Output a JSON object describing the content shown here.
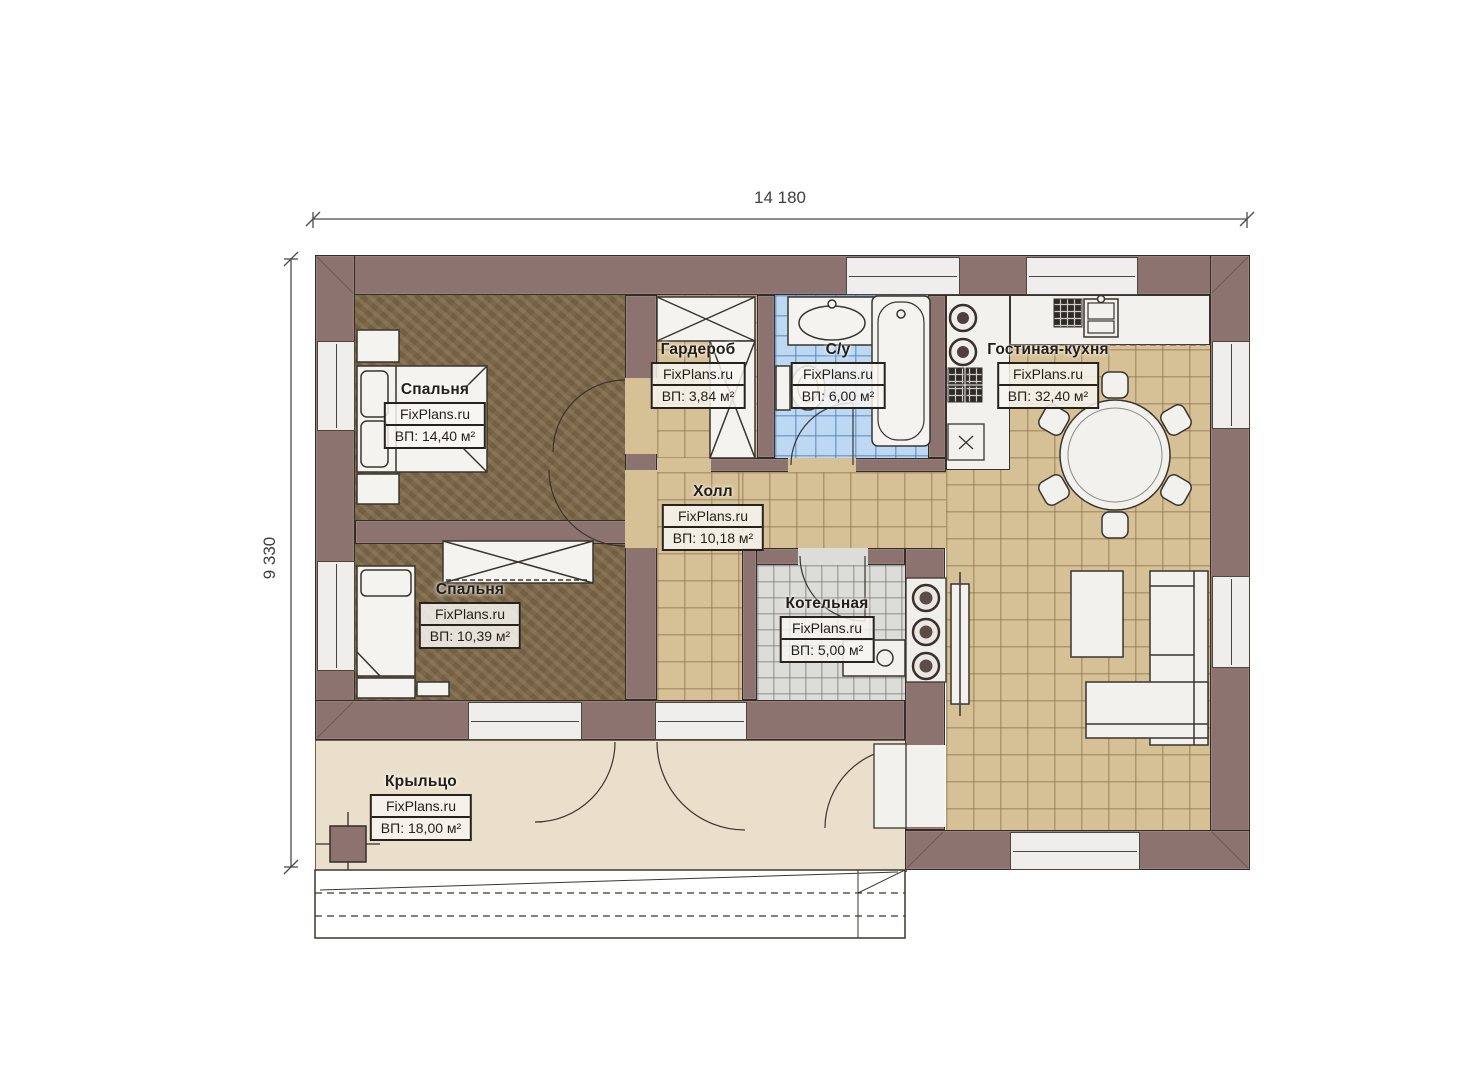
{
  "dimensions": {
    "width_label": "14 180",
    "height_label": "9 330"
  },
  "rooms": [
    {
      "id": "bedroom-1",
      "name": "Спальня",
      "brand": "FixPlans.ru",
      "area": "ВП: 14,40 м²"
    },
    {
      "id": "bedroom-2",
      "name": "Спальня",
      "brand": "FixPlans.ru",
      "area": "ВП: 10,39 м²"
    },
    {
      "id": "wardrobe",
      "name": "Гардероб",
      "brand": "FixPlans.ru",
      "area": "ВП: 3,84 м²"
    },
    {
      "id": "bathroom",
      "name": "С/у",
      "brand": "FixPlans.ru",
      "area": "ВП: 6,00 м²"
    },
    {
      "id": "hall",
      "name": "Холл",
      "brand": "FixPlans.ru",
      "area": "ВП: 10,18 м²"
    },
    {
      "id": "boiler-room",
      "name": "Котельная",
      "brand": "FixPlans.ru",
      "area": "ВП: 5,00 м²"
    },
    {
      "id": "living-kitchen",
      "name": "Гостиная-кухня",
      "brand": "FixPlans.ru",
      "area": "ВП: 32,40 м²"
    },
    {
      "id": "porch",
      "name": "Крыльцо",
      "brand": "FixPlans.ru",
      "area": "ВП: 18,00 м²"
    }
  ],
  "colors": {
    "wall": "#8c7370",
    "outline": "#332c27",
    "bedroom_floor": "#836e4d",
    "tile_beige": "#d6c095",
    "tile_blue": "#bcd8f3",
    "tile_gray": "#dcdcd8",
    "porch": "#e9dfca",
    "fixture_fill": "#f2f1ee"
  }
}
